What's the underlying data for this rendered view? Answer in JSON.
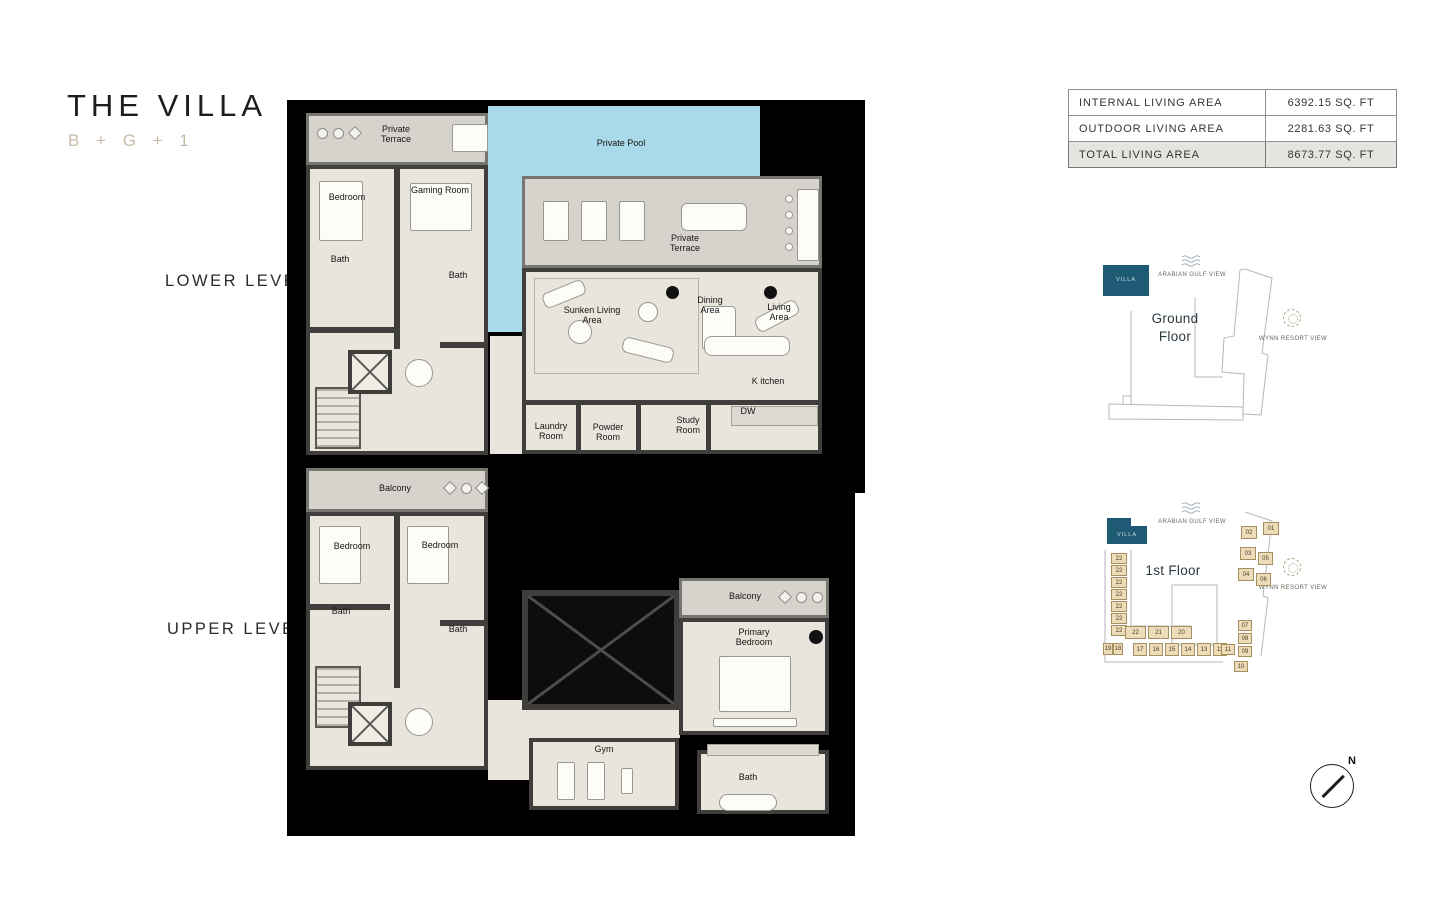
{
  "title": {
    "main": "THE VILLA",
    "subtitle": "B + G + 1"
  },
  "levels": {
    "lower": "LOWER LEVEL",
    "upper": "UPPER LEVEL"
  },
  "area_table": {
    "rows": [
      {
        "label": "INTERNAL LIVING AREA",
        "value": "6392.15 SQ. FT"
      },
      {
        "label": "OUTDOOR LIVING AREA",
        "value": "2281.63 SQ. FT"
      },
      {
        "label": "TOTAL LIVING AREA",
        "value": "8673.77 SQ. FT"
      }
    ]
  },
  "lower_plan": {
    "labels": {
      "terrace_top": "Private Terrace",
      "pool": "Private Pool",
      "bedroom": "Bedroom",
      "gaming_room": "Gaming Room",
      "bath1": "Bath",
      "bath2": "Bath",
      "terrace_main": "Private Terrace",
      "sunken_living": "Sunken Living Area",
      "dining": "Dining Area",
      "living": "Living Area",
      "kitchen": "K itchen",
      "laundry": "Laundry Room",
      "powder": "Powder Room",
      "study": "Study Room",
      "dw": "DW"
    }
  },
  "upper_plan": {
    "labels": {
      "balcony_left": "Balcony",
      "bedroom1": "Bedroom",
      "bedroom2": "Bedroom",
      "bath1": "Bath",
      "bath2": "Bath",
      "balcony_right": "Balcony",
      "primary_bedroom": "Primary Bedroom",
      "gym": "Gym",
      "bath3": "Bath"
    }
  },
  "site_map_ground": {
    "floor_label": "Ground Floor",
    "villa_label": "VILLA",
    "view_top": "ARABIAN GULF VIEW",
    "view_right": "WYNN RESORT VIEW"
  },
  "site_map_first": {
    "floor_label": "1st Floor",
    "villa_label": "VILLA",
    "view_top": "ARABIAN GULF VIEW",
    "view_right": "WYNN RESORT VIEW",
    "left_units": [
      "22",
      "22",
      "22",
      "22",
      "22",
      "22",
      "22"
    ],
    "mid_units": [
      "22",
      "21",
      "20"
    ],
    "bottom_units": [
      "19",
      "18",
      "17",
      "16",
      "15",
      "14",
      "13",
      "12"
    ],
    "right_units": [
      "02",
      "01",
      "03",
      "05",
      "04",
      "06"
    ],
    "corner_units": [
      "07",
      "08",
      "09",
      "11",
      "10"
    ]
  },
  "compass": {
    "label": "N"
  },
  "colors": {
    "villa_teal": "#1e5a73",
    "pool_blue": "#a9dae9",
    "unit_tan": "#ecdcba",
    "subtitle_tan": "#c6bba6",
    "plan_floor": "#e9e5dc",
    "terrace_gray": "#d6d3cc"
  }
}
